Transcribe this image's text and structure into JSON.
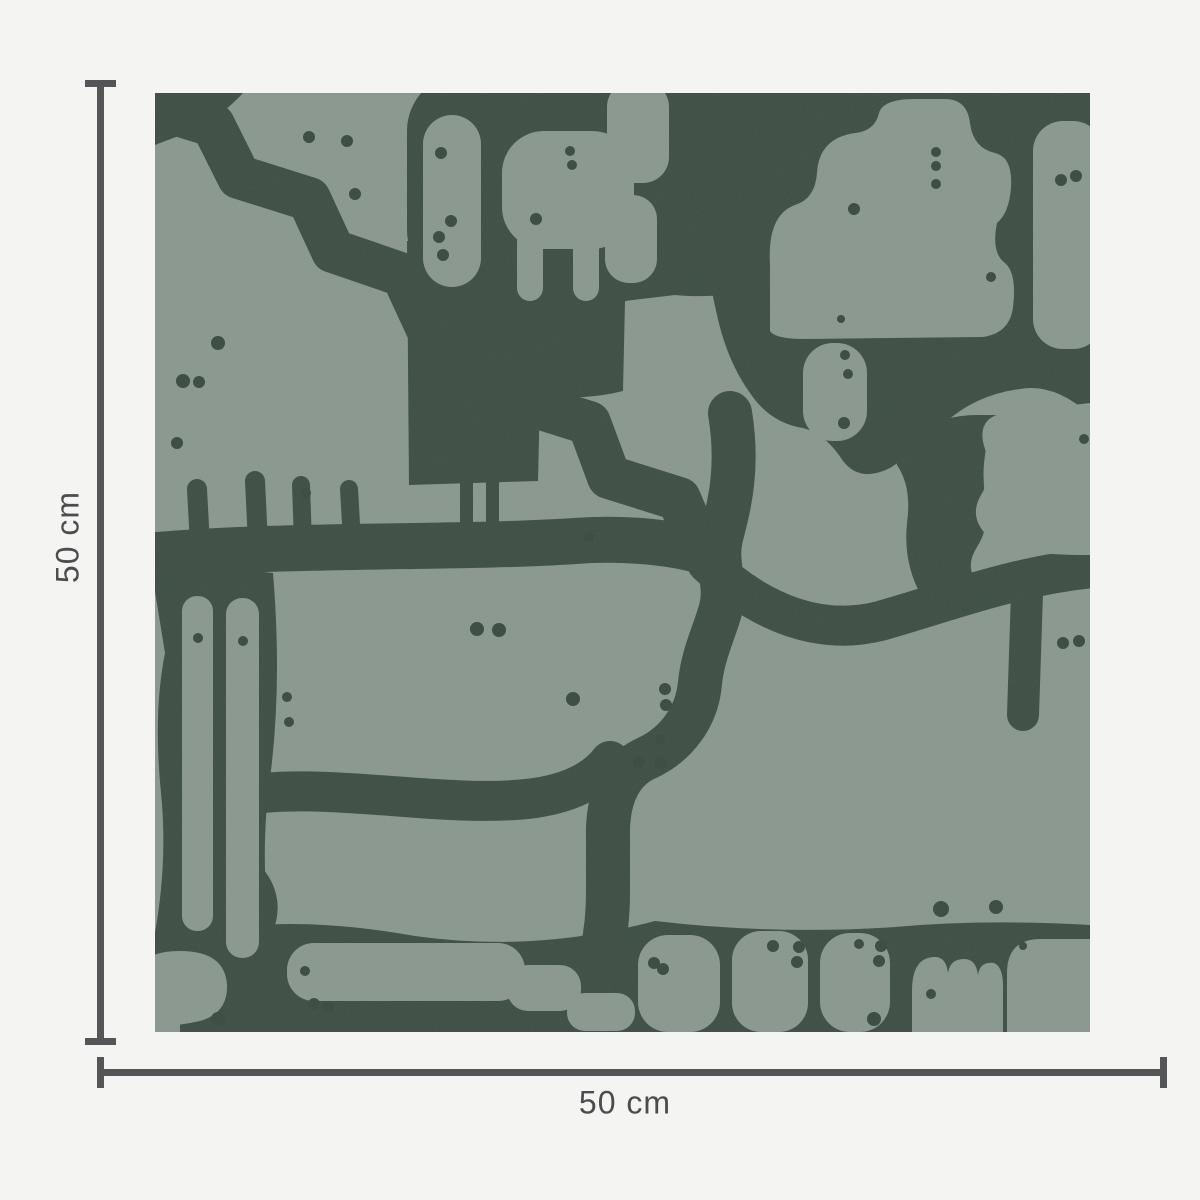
{
  "image_type": "product dimension diagram",
  "product": {
    "subject": "square wallpaper swatch with abstract organic blob pattern",
    "pattern_style": "light sage rounded blobs separated by dark forest-green channels with small scattered dots"
  },
  "dimensions": {
    "width_label": "50 cm",
    "height_label": "50 cm"
  },
  "colors": {
    "bg": "#f4f4f3",
    "line": "#545557",
    "text": "#4b4c4e",
    "light": "#86948b",
    "dark": "#394a40",
    "dot": "#35463c"
  }
}
